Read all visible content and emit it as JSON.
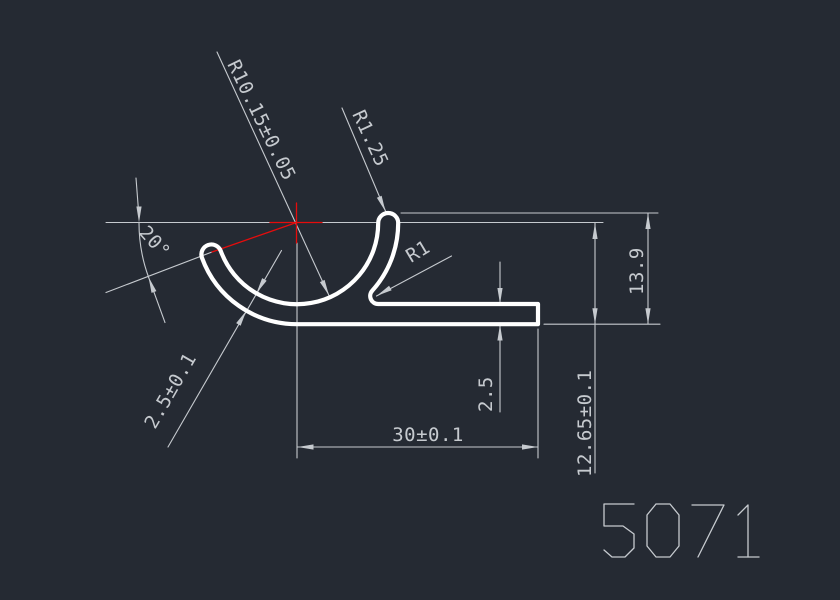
{
  "drawing": {
    "part_number": "5071",
    "colors": {
      "background": "#252a33",
      "profile": "#ffffff",
      "dimension": "#c6cacf",
      "construction": "#e60c0c"
    },
    "dimensions": {
      "large_radius": "R10.15±0.05",
      "hook_radius": "R1.25",
      "fillet_radius": "R1",
      "opening_angle": "20°",
      "wall_thickness": "2.5±0.1",
      "flange_thickness": "2.5",
      "overall_height": "13.9",
      "center_height": "12.65±0.1",
      "overall_width": "30±0.1"
    }
  }
}
